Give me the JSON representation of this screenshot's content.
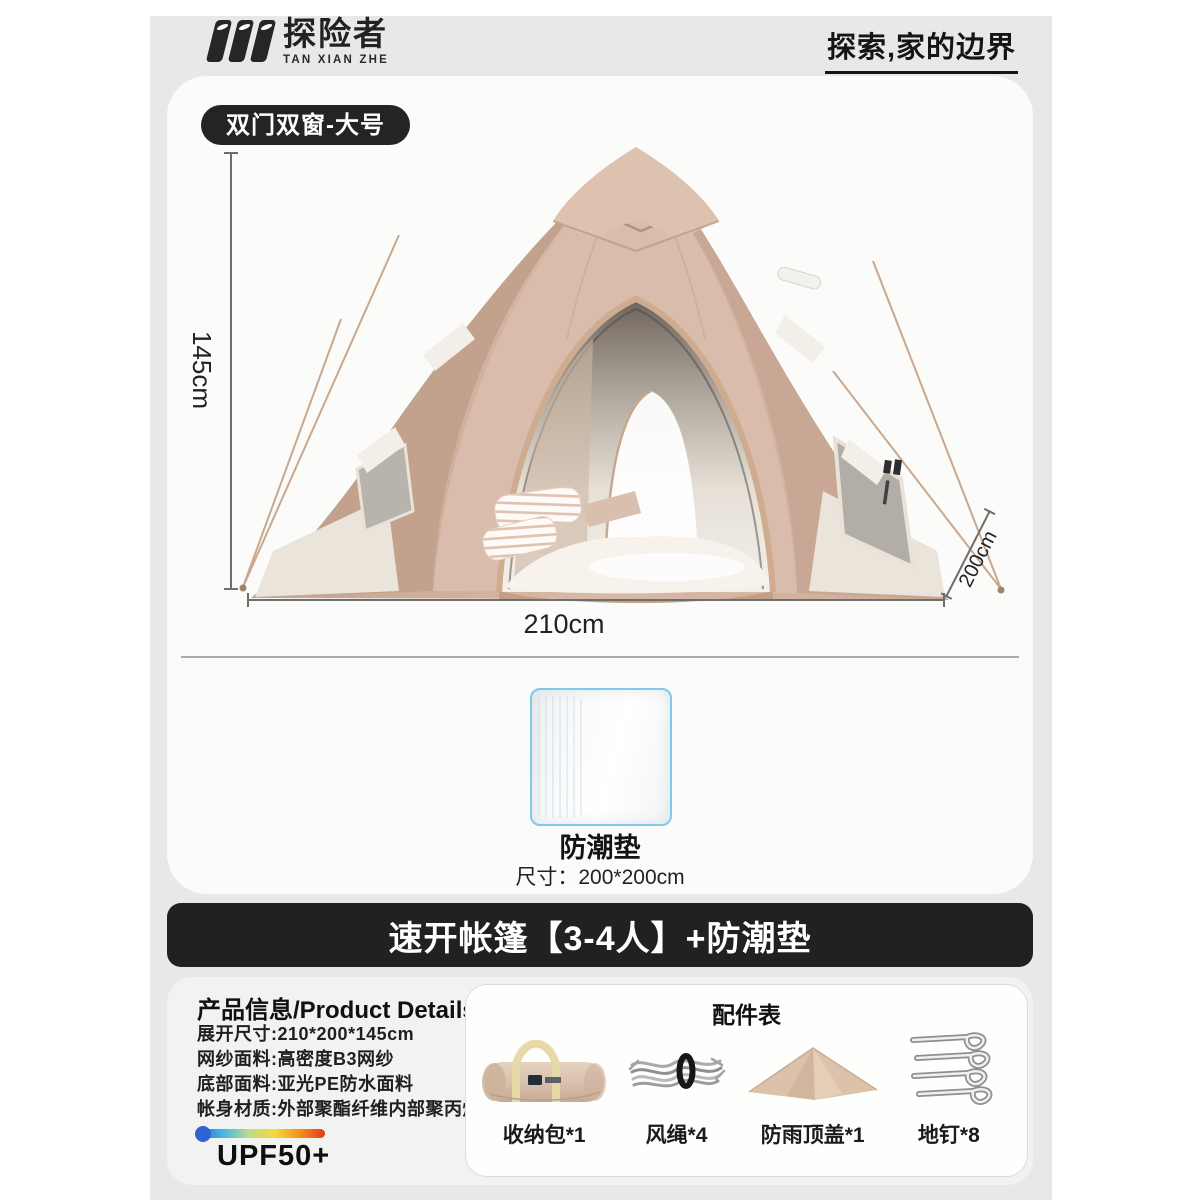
{
  "brand": {
    "name": "探险者",
    "name_en": "TAN XIAN ZHE",
    "slogan": "探索,家的边界"
  },
  "hero": {
    "variant_badge": "双门双窗-大号",
    "dim_height": "145cm",
    "dim_width": "210cm",
    "dim_depth": "200cm"
  },
  "mat": {
    "name": "防潮垫",
    "size": "尺寸：200*200cm"
  },
  "banner": {
    "title": "速开帐篷【3-4人】+防潮垫"
  },
  "details": {
    "title": "产品信息/Product Details",
    "specs": [
      "展开尺寸:210*200*145cm",
      "网纱面料:高密度B3网纱",
      "底部面料:亚光PE防水面料",
      "帐身材质:外部聚酯纤维内部聚丙烯"
    ],
    "upf": "UPF50+"
  },
  "accessories": {
    "title": "配件表",
    "items": [
      {
        "name": "收纳包*1",
        "icon": "storage-bag-icon"
      },
      {
        "name": "风绳*4",
        "icon": "wind-rope-icon"
      },
      {
        "name": "防雨顶盖*1",
        "icon": "rain-cover-icon"
      },
      {
        "name": "地钉*8",
        "icon": "ground-nails-icon"
      }
    ]
  },
  "colors": {
    "tent_fabric": "#d2b2a0",
    "accent_black": "#212121",
    "mat_border": "#82c7ee",
    "page_gray": "#e9e8e8",
    "upf_gradient": [
      "#2e63d2",
      "#45b8e8",
      "#b9dc8a",
      "#f2d93f",
      "#f29b1d",
      "#e23a1a"
    ]
  }
}
